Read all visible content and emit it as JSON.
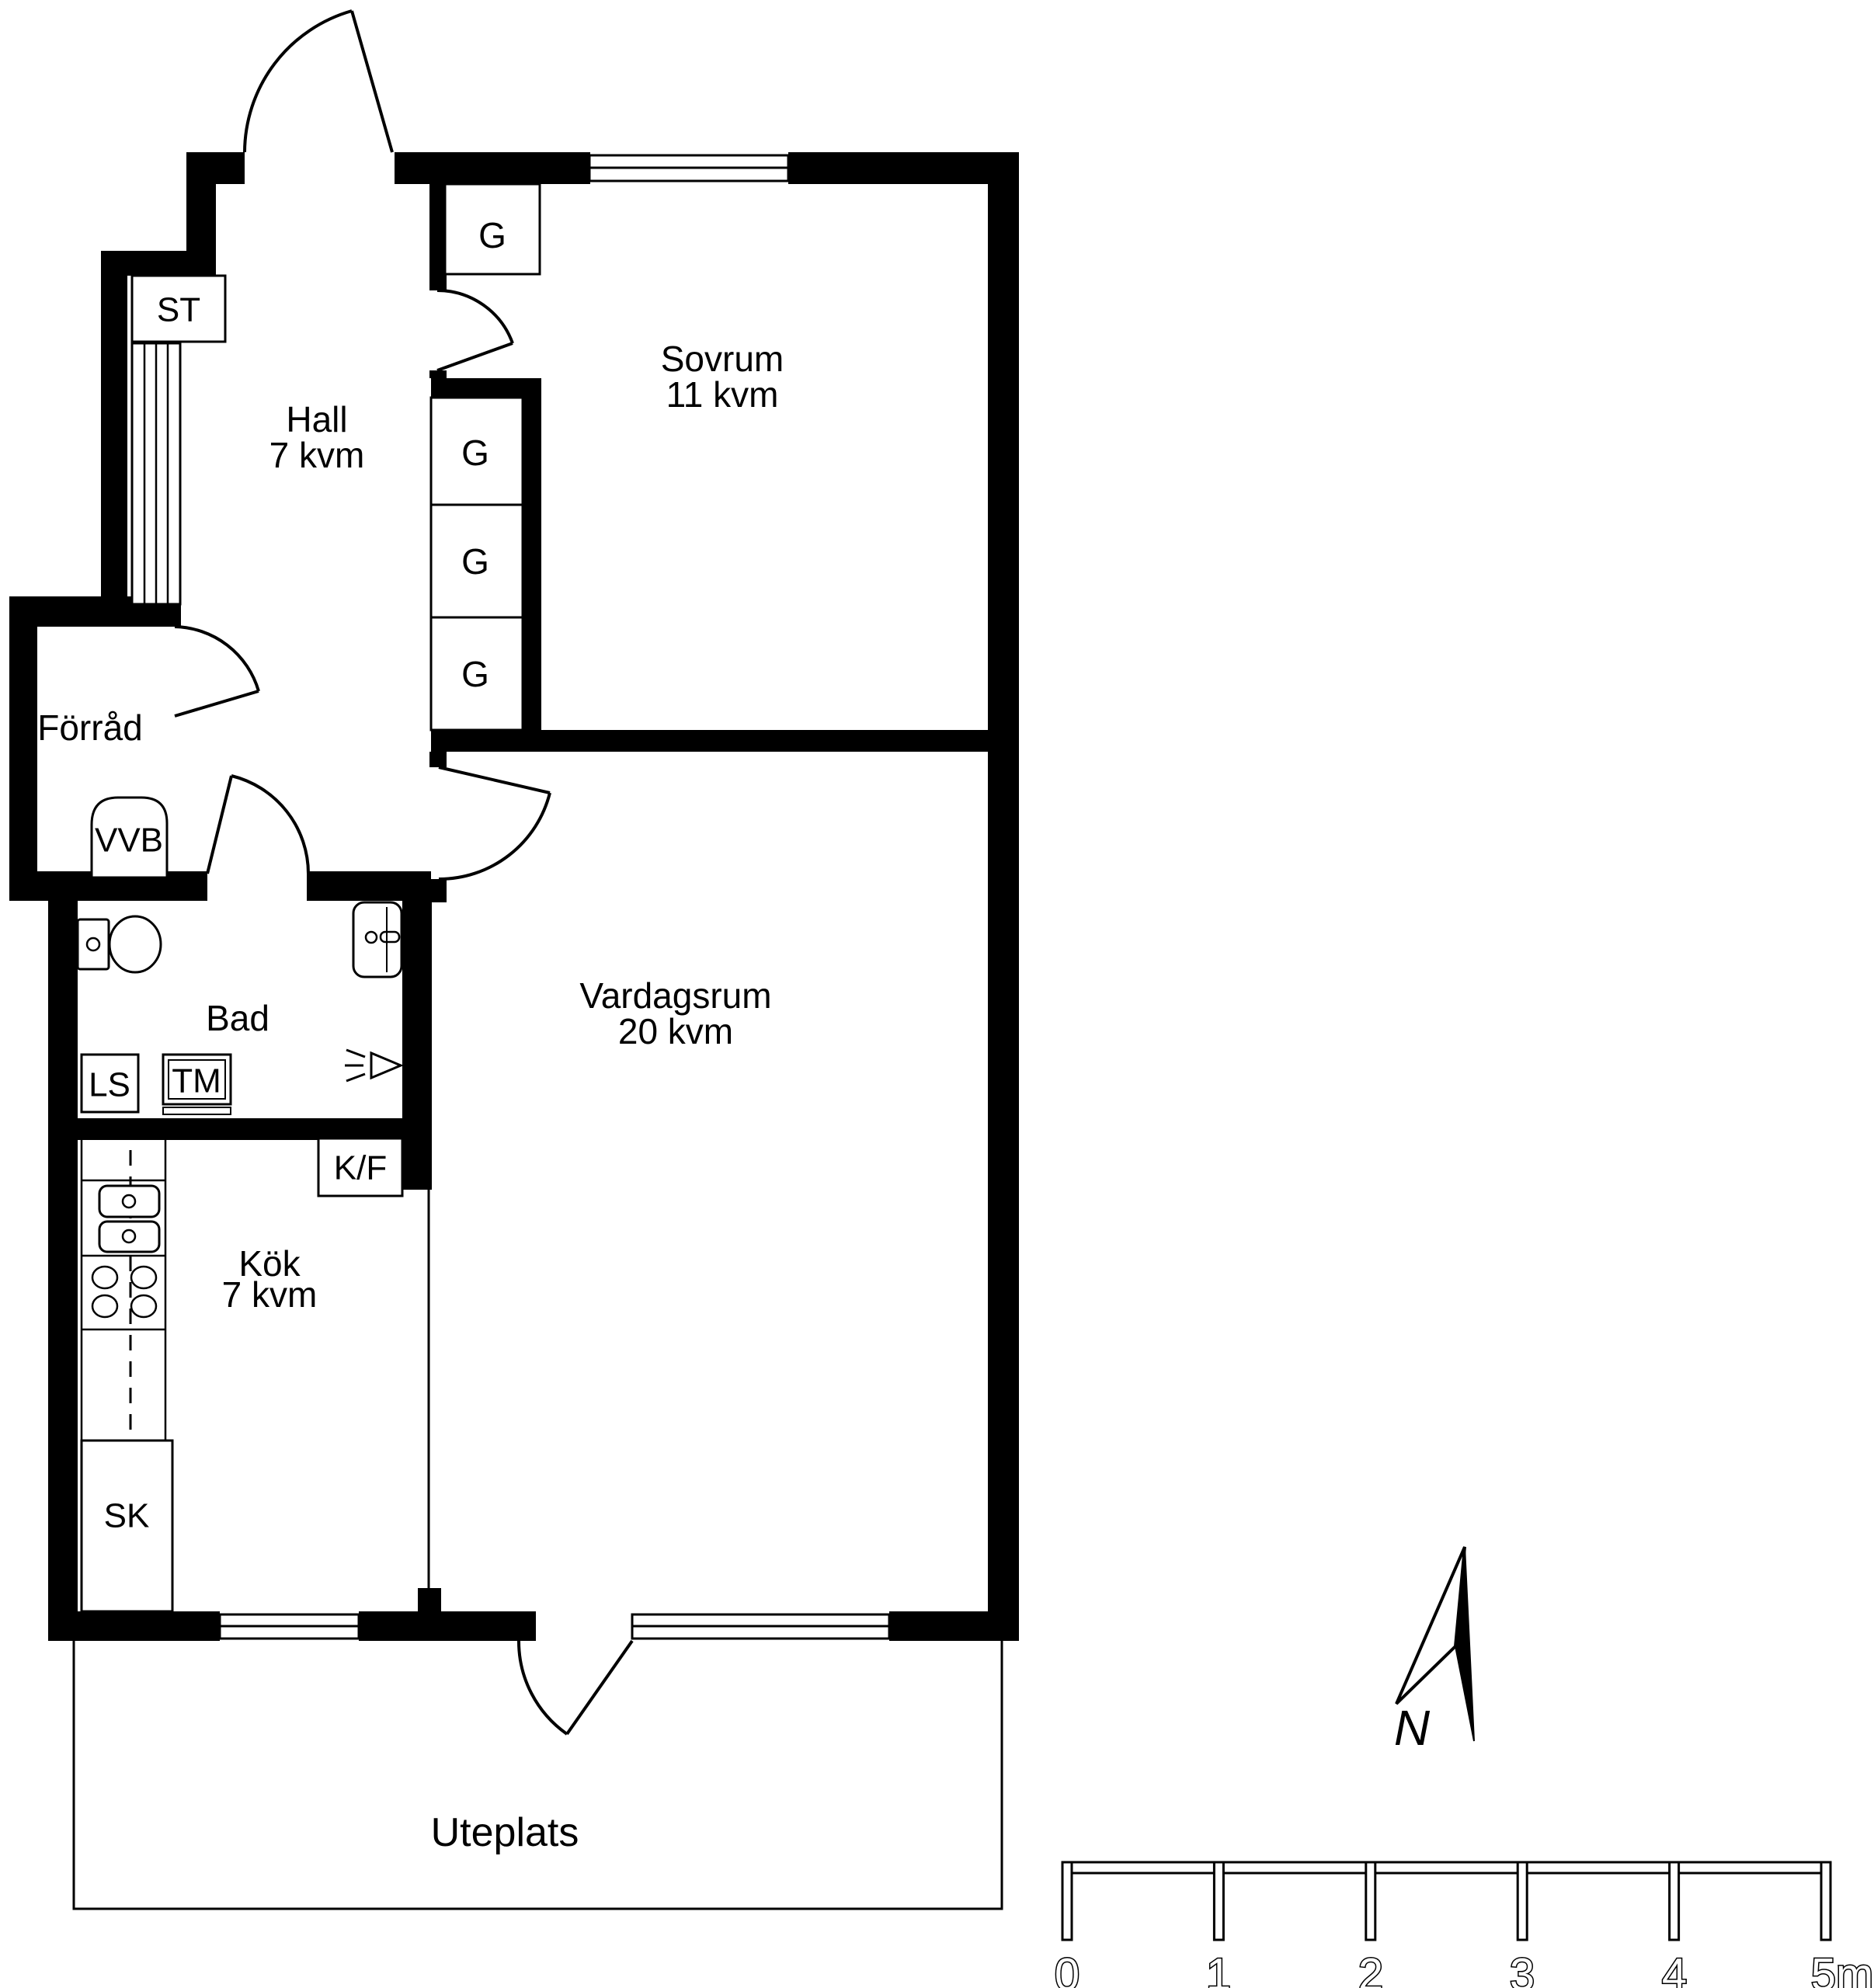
{
  "rooms": [
    {
      "name": "Hall",
      "area": "7 kvm"
    },
    {
      "name": "Sovrum",
      "area": "11 kvm"
    },
    {
      "name": "Vardagsrum",
      "area": "20 kvm"
    },
    {
      "name": "Kök",
      "area": "7 kvm"
    },
    {
      "name": "Bad",
      "area": ""
    },
    {
      "name": "Förråd",
      "area": ""
    },
    {
      "name": "Uteplats",
      "area": ""
    }
  ],
  "fixtures": {
    "st": "ST",
    "vvb": "VVB",
    "ls": "LS",
    "tm": "TM",
    "kf": "K/F",
    "sk": "SK"
  },
  "wardrobes": [
    {
      "label": "G"
    },
    {
      "label": "G"
    },
    {
      "label": "G"
    },
    {
      "label": "G"
    }
  ],
  "compass": {
    "label": "N"
  },
  "scale_bar": {
    "labels": [
      "0",
      "1",
      "2",
      "3",
      "4",
      "5m"
    ]
  },
  "colors": {
    "wall": "#000000",
    "background": "#ffffff",
    "line": "#000000"
  }
}
